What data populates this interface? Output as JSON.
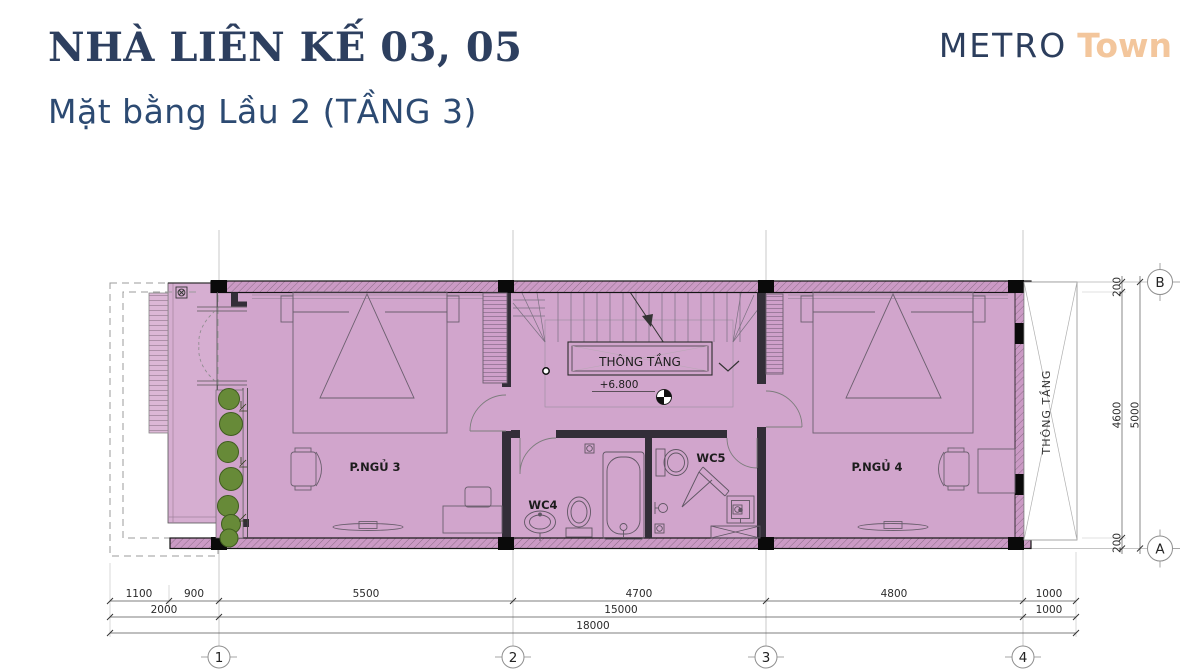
{
  "header": {
    "title": "NHÀ LIÊN KẾ 03, 05",
    "subtitle": "Mặt bằng Lầu 2 (TẦNG 3)"
  },
  "logo": {
    "metro": "METRO",
    "town": "Town"
  },
  "colors": {
    "navy": "#2d3f5f",
    "peach": "#f3c69c",
    "room_fill": "#d1a5cc",
    "balcony_fill": "#d6aed1",
    "wall_hatch": "#cb9ac5",
    "plant_green": "#678a38"
  },
  "plan": {
    "labels": {
      "bedroom3": "P.NGỦ 3",
      "bedroom4": "P.NGỦ 4",
      "wc4": "WC4",
      "wc5": "WC5",
      "void_box": "THÔNG TẦNG",
      "void_side": "THÔNG TẦNG",
      "level": "+6.800"
    },
    "grid": {
      "columns": [
        "1",
        "2",
        "3",
        "4"
      ],
      "rows_right": [
        "B",
        "A"
      ]
    },
    "dims": {
      "row1": [
        "1100",
        "900",
        "5500",
        "4700",
        "4800",
        "1000"
      ],
      "row2": [
        "2000",
        "15000",
        "1000"
      ],
      "row3": [
        "18000"
      ],
      "right_inner": [
        "200",
        "4600",
        "200"
      ],
      "right_outer": [
        "5000"
      ]
    }
  }
}
